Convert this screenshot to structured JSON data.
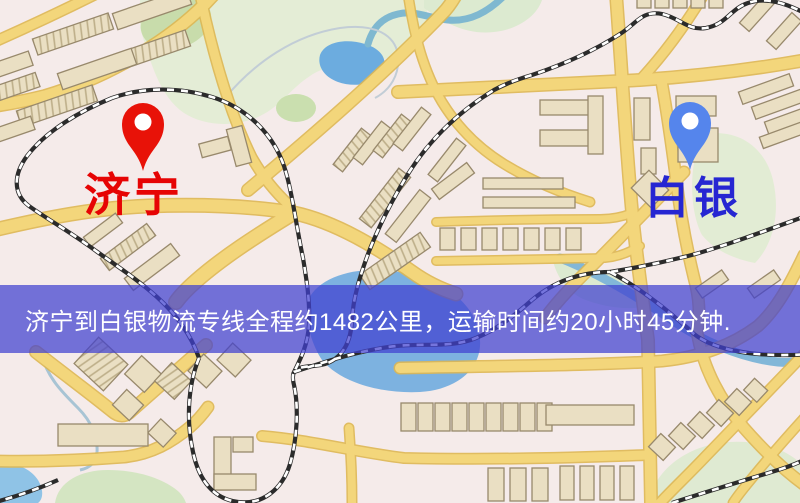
{
  "map": {
    "markers": {
      "origin": {
        "label": "济宁",
        "pin_color": "#e81208",
        "label_color": "#e60404"
      },
      "destination": {
        "label": "白银",
        "pin_color": "#5585ec",
        "label_color": "#2626d2"
      }
    },
    "banner": {
      "text": "济宁到白银物流专线全程约1482公里，运输时间约20小时45分钟.",
      "bg_color": "#4040d0",
      "text_color": "#ffffff"
    },
    "colors": {
      "background": "#f5ebea",
      "road": "#f3d67b",
      "road_edge": "#deb753",
      "water": "#7db2e0",
      "park": "#e4edd6",
      "railway": "#2b2b2b",
      "building": "#eadfc3"
    }
  }
}
